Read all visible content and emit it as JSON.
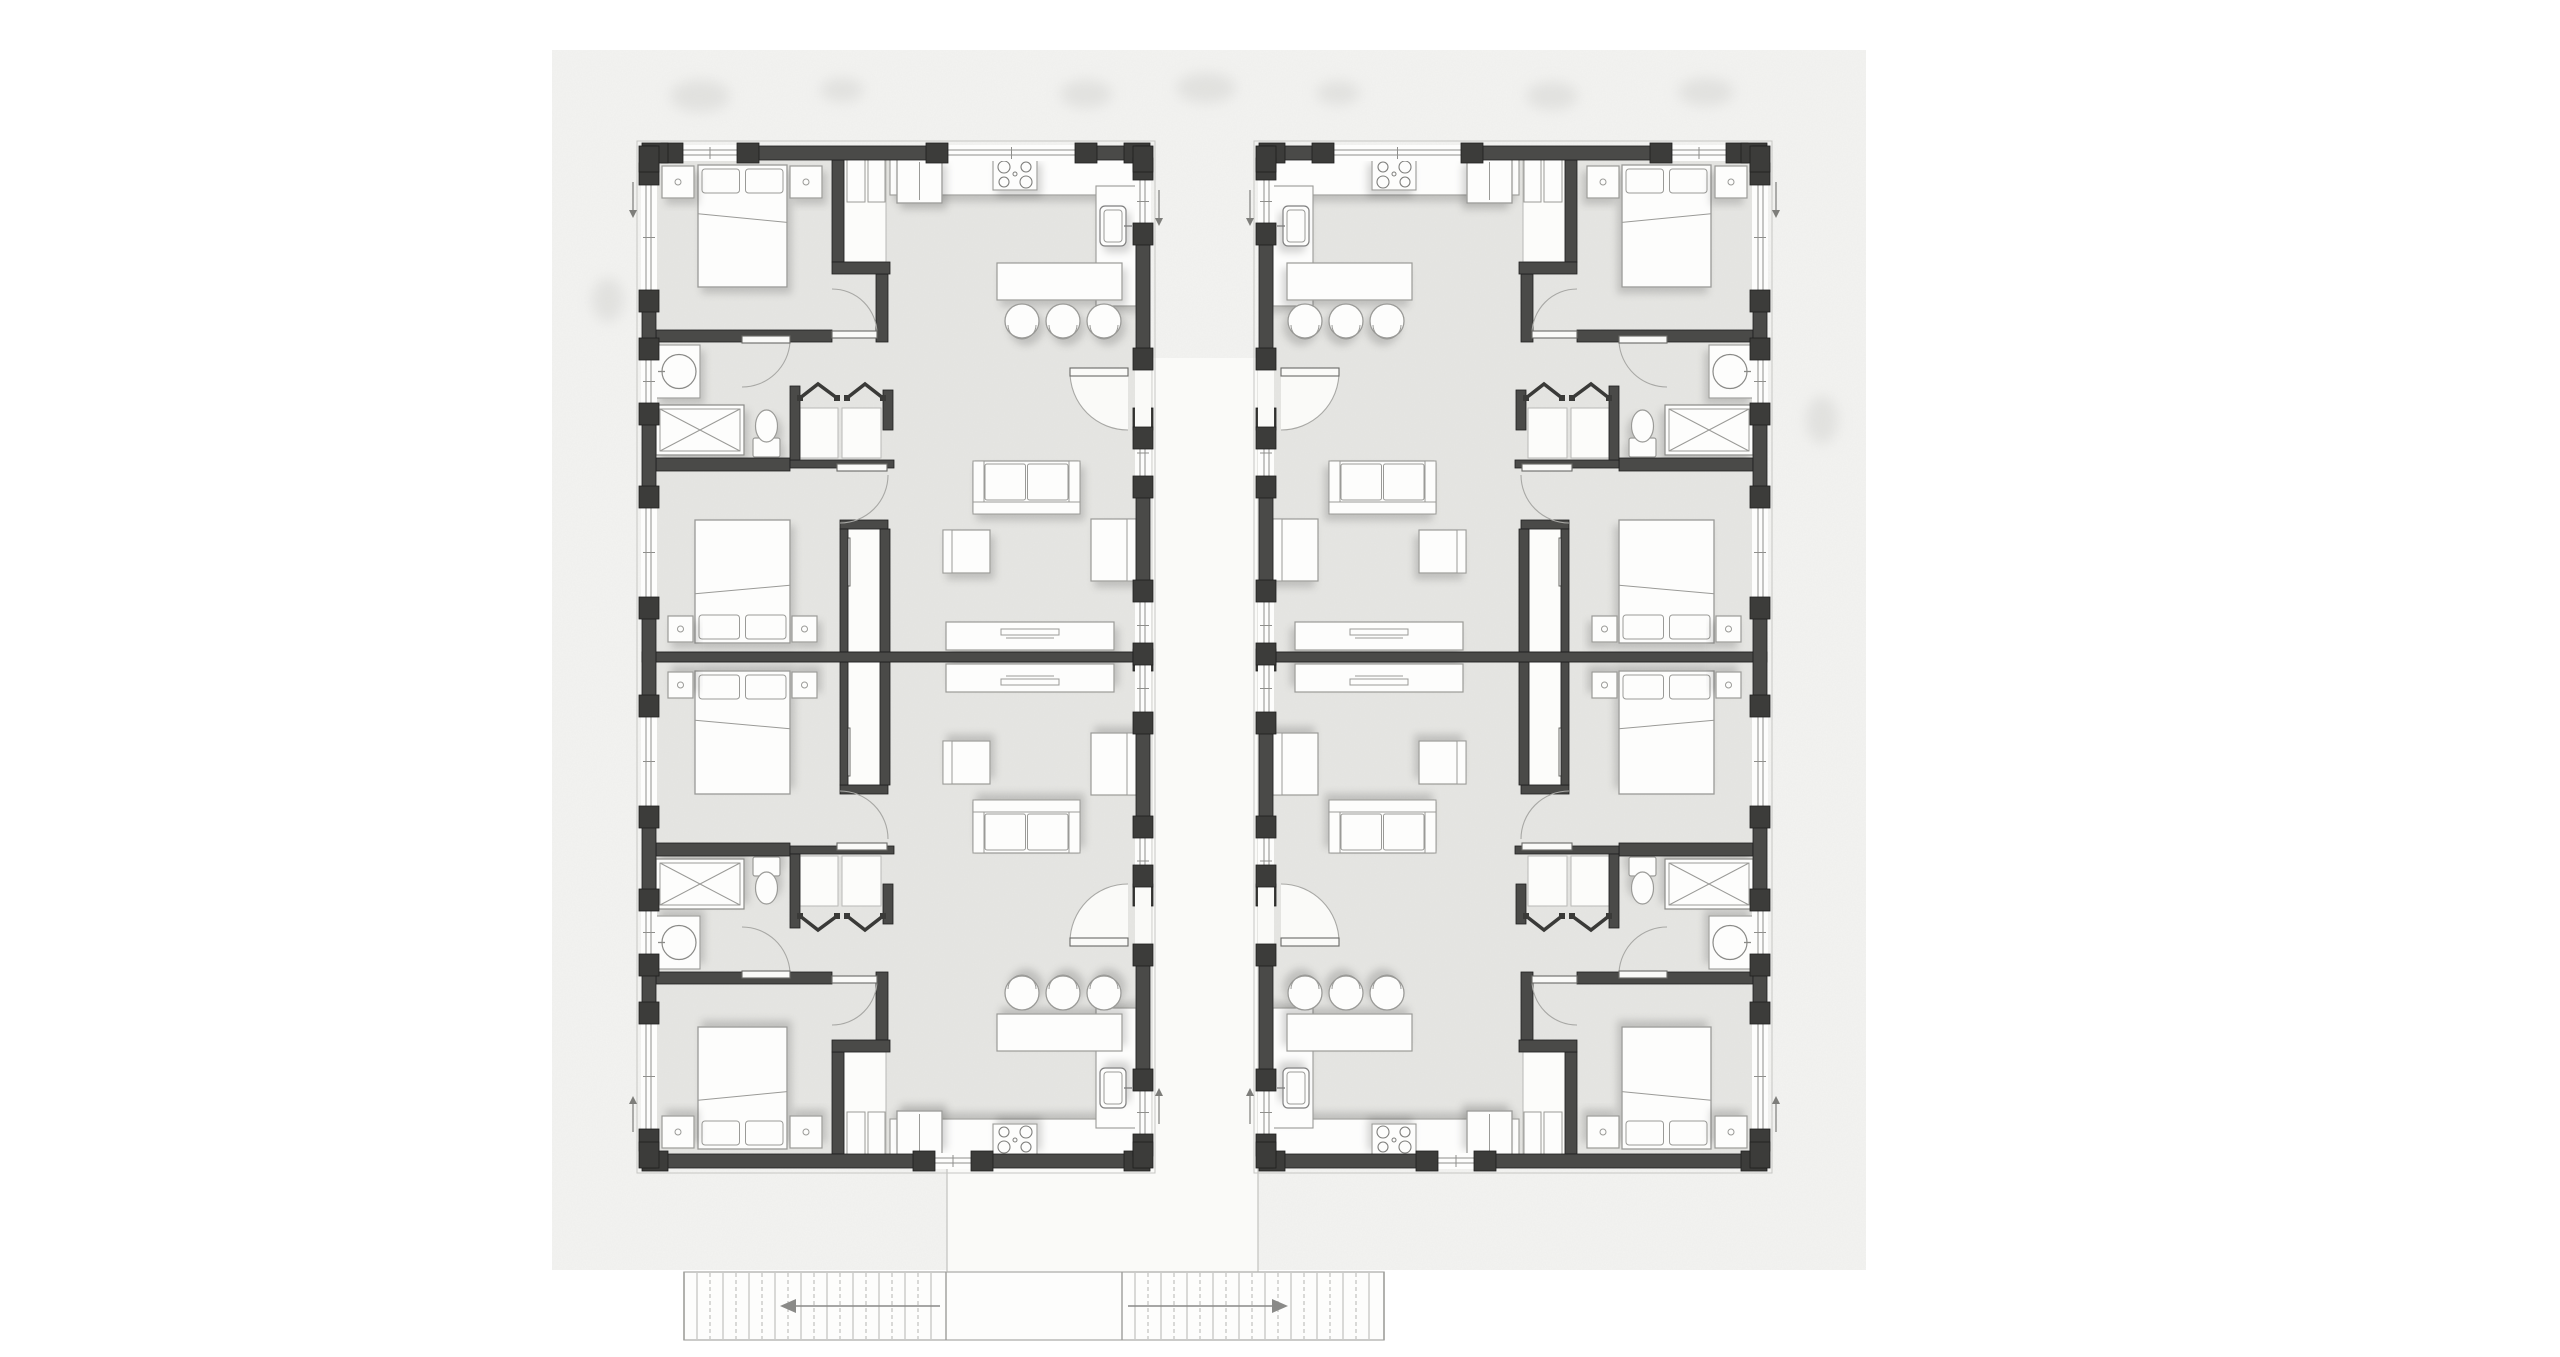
{
  "meta": {
    "description": "Architectural floor plan: two mirrored residential units (four apartments) with central walkway and exterior stairs below. No text labels are rendered in the drawing."
  },
  "colors": {
    "page": "#ffffff",
    "canvas": "#f3f3f1",
    "floor": "#e6e6e3",
    "wall": "#4a4a48",
    "wallDark": "#3c3c3a",
    "wallEdge": "#1f1f1f",
    "furnFill": "#fdfdfc",
    "furnStroke": "#9a9a97",
    "white": "#fafaf8",
    "lineLight": "#b5b5b2",
    "lineMed": "#8f8f8c",
    "arcStroke": "#a8a8a5",
    "tree": "#d4d4d1"
  },
  "view": {
    "w": 2560,
    "h": 1357
  },
  "site": {
    "canvas": {
      "x": 552,
      "y": 50,
      "w": 1314,
      "h": 1220
    },
    "trees": [
      {
        "x": 700,
        "y": 96,
        "rx": 30,
        "ry": 16
      },
      {
        "x": 842,
        "y": 90,
        "rx": 22,
        "ry": 12
      },
      {
        "x": 1086,
        "y": 94,
        "rx": 26,
        "ry": 14
      },
      {
        "x": 1206,
        "y": 88,
        "rx": 30,
        "ry": 15
      },
      {
        "x": 1338,
        "y": 93,
        "rx": 22,
        "ry": 12
      },
      {
        "x": 1552,
        "y": 96,
        "rx": 26,
        "ry": 14
      },
      {
        "x": 1706,
        "y": 92,
        "rx": 28,
        "ry": 14
      },
      {
        "x": 608,
        "y": 300,
        "rx": 16,
        "ry": 22
      },
      {
        "x": 1822,
        "y": 420,
        "rx": 16,
        "ry": 24
      }
    ],
    "walkway": {
      "vertical": {
        "x": 1152,
        "y": 358,
        "w": 106,
        "h": 914
      },
      "connector": {
        "x": 947,
        "y": 1168,
        "w": 311,
        "h": 104
      }
    },
    "stairs": {
      "x": 684,
      "y": 1272,
      "w": 700,
      "h": 68,
      "tread": 13,
      "flights": [
        {
          "x1": 684,
          "x2": 946,
          "dir": "left"
        },
        {
          "x1": 1122,
          "x2": 1384,
          "dir": "right"
        }
      ]
    }
  },
  "units": [
    {
      "name": "unit-left",
      "x": 642,
      "y": 146,
      "mirror": false
    },
    {
      "name": "unit-right",
      "x": 1767,
      "y": 146,
      "mirror": true
    }
  ],
  "unit": {
    "w": 508,
    "h": 1022,
    "wallTh": 14,
    "floor": {
      "x": 14,
      "y": 14,
      "w": 480,
      "h": 994
    },
    "centerWall": {
      "x": 0,
      "y": 506,
      "w": 508,
      "h": 10
    },
    "extWalls": [
      {
        "name": "wall-top",
        "o": "h",
        "x": 0,
        "y": 0,
        "len": 508,
        "windows": [
          [
            41,
            95
          ],
          [
            306,
            433
          ]
        ],
        "doors": []
      },
      {
        "name": "wall-bottom",
        "o": "h",
        "x": 0,
        "y": 1008,
        "len": 508,
        "windows": [
          [
            293,
            329
          ]
        ],
        "doors": []
      },
      {
        "name": "wall-left",
        "o": "v",
        "x": 0,
        "y": 0,
        "len": 1022,
        "windows": [
          [
            39,
            144
          ],
          [
            214,
            257
          ],
          [
            362,
            451
          ],
          [
            571,
            660
          ],
          [
            765,
            808
          ],
          [
            878,
            983
          ]
        ],
        "doors": []
      },
      {
        "name": "wall-right",
        "o": "v",
        "x": 494,
        "y": 0,
        "len": 1022,
        "windows": [
          [
            34,
            77
          ],
          [
            284,
            330
          ],
          [
            456,
            503
          ],
          [
            519,
            566
          ],
          [
            692,
            738
          ],
          [
            945,
            988
          ]
        ],
        "doors": [
          [
            224,
            281
          ],
          [
            741,
            798
          ]
        ]
      }
    ],
    "arrows": [
      {
        "x": -9,
        "y1": 36,
        "y2": 66,
        "dir": "down"
      },
      {
        "x": -9,
        "y1": 956,
        "y2": 986,
        "dir": "up"
      },
      {
        "x": 517,
        "y1": 44,
        "y2": 74,
        "dir": "down"
      },
      {
        "x": 517,
        "y1": 948,
        "y2": 978,
        "dir": "up"
      }
    ]
  },
  "apartment": {
    "walls": [
      [
        14,
        184,
        176,
        12
      ],
      [
        234,
        128,
        12,
        68
      ],
      [
        190,
        14,
        12,
        102
      ],
      [
        190,
        116,
        58,
        12
      ],
      [
        14,
        312,
        134,
        13
      ],
      [
        148,
        314,
        104,
        8
      ],
      [
        148,
        240,
        10,
        74
      ],
      [
        241,
        244,
        10,
        40
      ],
      [
        198,
        374,
        48,
        9
      ],
      [
        198,
        383,
        8,
        123
      ],
      [
        238,
        383,
        10,
        123
      ]
    ],
    "whites": [
      {
        "name": "wardrobe",
        "r": [
          202,
          8,
          42,
          108
        ]
      },
      {
        "name": "hall-closet-bay",
        "r": [
          158,
          262,
          38,
          50
        ]
      },
      {
        "name": "hall-closet-bay",
        "r": [
          200,
          262,
          39,
          50
        ]
      },
      {
        "name": "bedroom2-closet-bay",
        "r": [
          206,
          383,
          32,
          123
        ]
      }
    ],
    "wardrobePanels": [
      [
        205,
        12,
        18,
        44
      ],
      [
        226,
        12,
        17,
        44
      ]
    ],
    "slider": [
      202,
      392,
      6,
      48
    ],
    "bifolds": [
      [
        158,
        252,
        176,
        238,
        195,
        252
      ],
      [
        205,
        252,
        223,
        238,
        241,
        252
      ]
    ],
    "furniture": [
      {
        "t": "bed",
        "name": "bed-primary",
        "x": 56,
        "y": 19,
        "w": 89,
        "h": 122,
        "head": "top"
      },
      {
        "t": "nightstand",
        "name": "nightstand",
        "x": 20,
        "y": 20,
        "w": 32,
        "h": 32
      },
      {
        "t": "nightstand",
        "name": "nightstand",
        "x": 148,
        "y": 20,
        "w": 32,
        "h": 32
      },
      {
        "t": "bed",
        "name": "bed-second",
        "x": 53,
        "y": 374,
        "w": 95,
        "h": 123,
        "head": "bottom"
      },
      {
        "t": "nightstand",
        "name": "nightstand",
        "x": 26,
        "y": 470,
        "w": 25,
        "h": 26
      },
      {
        "t": "nightstand",
        "name": "nightstand",
        "x": 150,
        "y": 470,
        "w": 25,
        "h": 26
      },
      {
        "t": "counter",
        "name": "kitchen-counter",
        "x": 248,
        "y": 11,
        "w": 246,
        "h": 38
      },
      {
        "t": "fridge",
        "name": "fridge",
        "x": 255,
        "y": 13,
        "w": 45,
        "h": 44
      },
      {
        "t": "stove",
        "name": "stove",
        "x": 351,
        "y": 12,
        "w": 44,
        "h": 32
      },
      {
        "t": "counter",
        "name": "kitchen-counter",
        "x": 454,
        "y": 40,
        "w": 40,
        "h": 120
      },
      {
        "t": "sink",
        "name": "kitchen-sink",
        "x": 458,
        "y": 60,
        "w": 26,
        "h": 40
      },
      {
        "t": "island",
        "name": "kitchen-island",
        "x": 355,
        "y": 117,
        "w": 125,
        "h": 37
      },
      {
        "t": "stool",
        "name": "bar-stool",
        "x": 380,
        "y": 175,
        "r": 17
      },
      {
        "t": "stool",
        "name": "bar-stool",
        "x": 421,
        "y": 175,
        "r": 17
      },
      {
        "t": "stool",
        "name": "bar-stool",
        "x": 462,
        "y": 175,
        "r": 17
      },
      {
        "t": "sofa",
        "name": "sofa",
        "x": 331,
        "y": 315,
        "w": 107,
        "h": 53
      },
      {
        "t": "armchair",
        "name": "armchair",
        "x": 449,
        "y": 373,
        "w": 45,
        "h": 62,
        "back": "right"
      },
      {
        "t": "armchair",
        "name": "armchair",
        "x": 301,
        "y": 384,
        "w": 47,
        "h": 43,
        "back": "left"
      },
      {
        "t": "desk",
        "name": "desk",
        "x": 304,
        "y": 476,
        "w": 168,
        "h": 28
      },
      {
        "t": "vanity",
        "name": "bath-vanity",
        "x": 14,
        "y": 199,
        "w": 44,
        "h": 53
      },
      {
        "t": "shower",
        "name": "shower",
        "x": 14,
        "y": 259,
        "w": 88,
        "h": 50
      },
      {
        "t": "toilet",
        "name": "toilet",
        "x": 111,
        "y": 264,
        "w": 27,
        "h": 47
      }
    ],
    "doors": [
      {
        "name": "entry-door",
        "leaf": [
          428,
          222,
          58,
          8
        ],
        "hinge": [
          486,
          226
        ],
        "from": [
          428,
          226
        ],
        "to": [
          486,
          284
        ],
        "sweep": 0,
        "pie": true
      },
      {
        "name": "bathroom-door",
        "leaf": [
          100,
          190,
          48,
          7
        ],
        "hinge": [
          100,
          193
        ],
        "from": [
          148,
          196
        ],
        "to": [
          100,
          241
        ],
        "sweep": 1,
        "pie": false
      },
      {
        "name": "bedroom1-door",
        "leaf": [
          190,
          185,
          45,
          7
        ],
        "hinge": [
          190,
          188
        ],
        "from": [
          235,
          188
        ],
        "to": [
          190,
          143
        ],
        "sweep": 0,
        "pie": false
      },
      {
        "name": "bedroom2-door",
        "leaf": [
          195,
          318,
          50,
          7
        ],
        "hinge": [
          198,
          329
        ],
        "from": [
          246,
          329
        ],
        "to": [
          198,
          377
        ],
        "sweep": 1,
        "pie": false
      }
    ]
  }
}
